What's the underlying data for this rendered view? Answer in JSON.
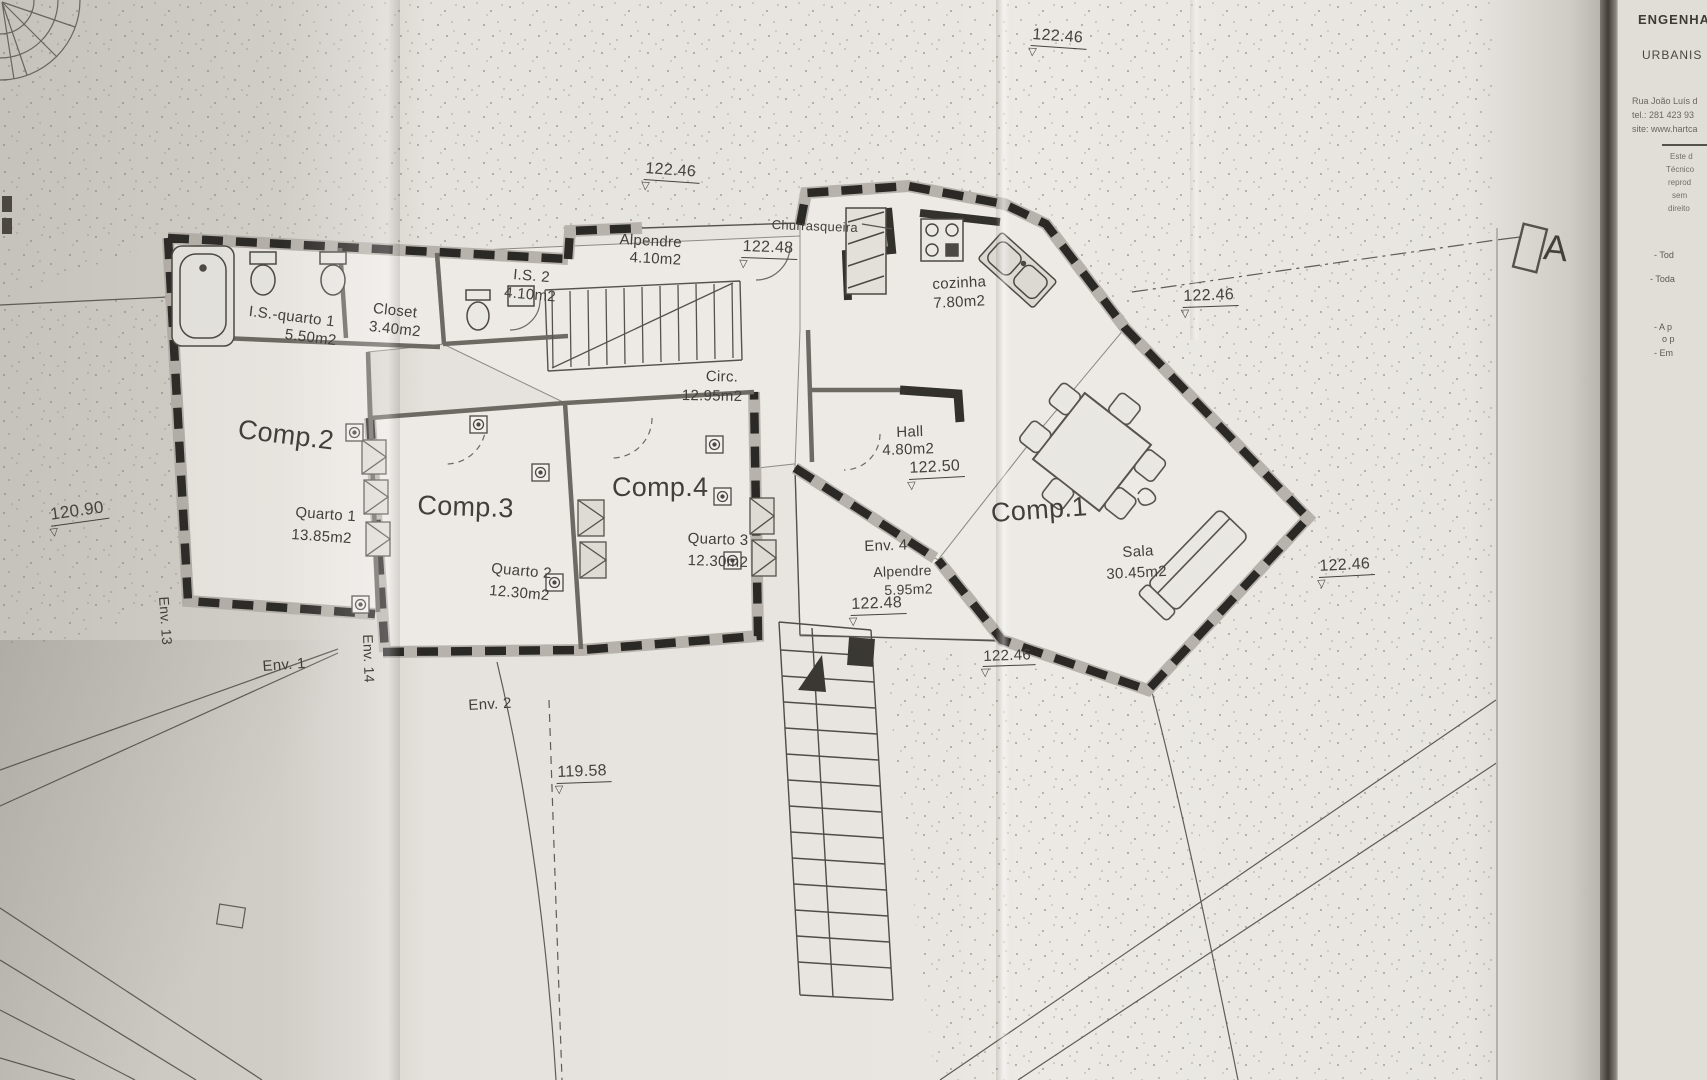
{
  "plan": {
    "rooms": {
      "comp1": "Comp.1",
      "comp2": "Comp.2",
      "comp3": "Comp.3",
      "comp4": "Comp.4"
    },
    "spaces": {
      "is_quarto1": {
        "name": "I.S.-quarto 1",
        "area": "5.50m2"
      },
      "closet": {
        "name": "Closet",
        "area": "3.40m2"
      },
      "is2": {
        "name": "I.S. 2",
        "area": "4.10m2"
      },
      "alpendre_entrada": {
        "name": "Alpendre",
        "area": "4.10m2"
      },
      "churrasqueira": {
        "name": "Churrasqueira"
      },
      "cozinha": {
        "name": "cozinha",
        "area": "7.80m2"
      },
      "circ": {
        "name": "Circ.",
        "area": "12.95m2"
      },
      "hall": {
        "name": "Hall",
        "area": "4.80m2"
      },
      "quarto1": {
        "name": "Quarto 1",
        "area": "13.85m2"
      },
      "quarto2": {
        "name": "Quarto 2",
        "area": "12.30m2"
      },
      "quarto3": {
        "name": "Quarto 3",
        "area": "12.30m2"
      },
      "alpendre_env4": {
        "name": "Alpendre",
        "area": "5.95m2"
      },
      "sala": {
        "name": "Sala",
        "area": "30.45m2"
      }
    },
    "env": {
      "env1": "Env. 1",
      "env2": "Env. 2",
      "env4": "Env. 4",
      "env13": "Env. 13",
      "env14": "Env. 14"
    },
    "elevations": {
      "e1": "122.46",
      "e2": "122.46",
      "e3": "122.48",
      "e4": "122.46",
      "e5": "122.50",
      "e6": "122.48",
      "e7": "122.46",
      "e8": "122.46",
      "e9": "120.90",
      "e10": "119.58"
    },
    "section_marker": "A"
  },
  "title_block": {
    "line1": "ENGENHA",
    "line2": "URBANIS",
    "address": "Rua João Luís d",
    "tel": "tel.: 281 423 93",
    "site": "site: www.hartca",
    "fine_print": [
      "Este d",
      "Técnico",
      "reprod",
      "sem",
      "direito"
    ],
    "notes": [
      "- Tod",
      "- Toda",
      "- A p",
      "o p",
      "- Em"
    ]
  },
  "colors": {
    "paper": "#e9e6e1",
    "ink": "#3f3d38",
    "wall": "#2b2926"
  }
}
